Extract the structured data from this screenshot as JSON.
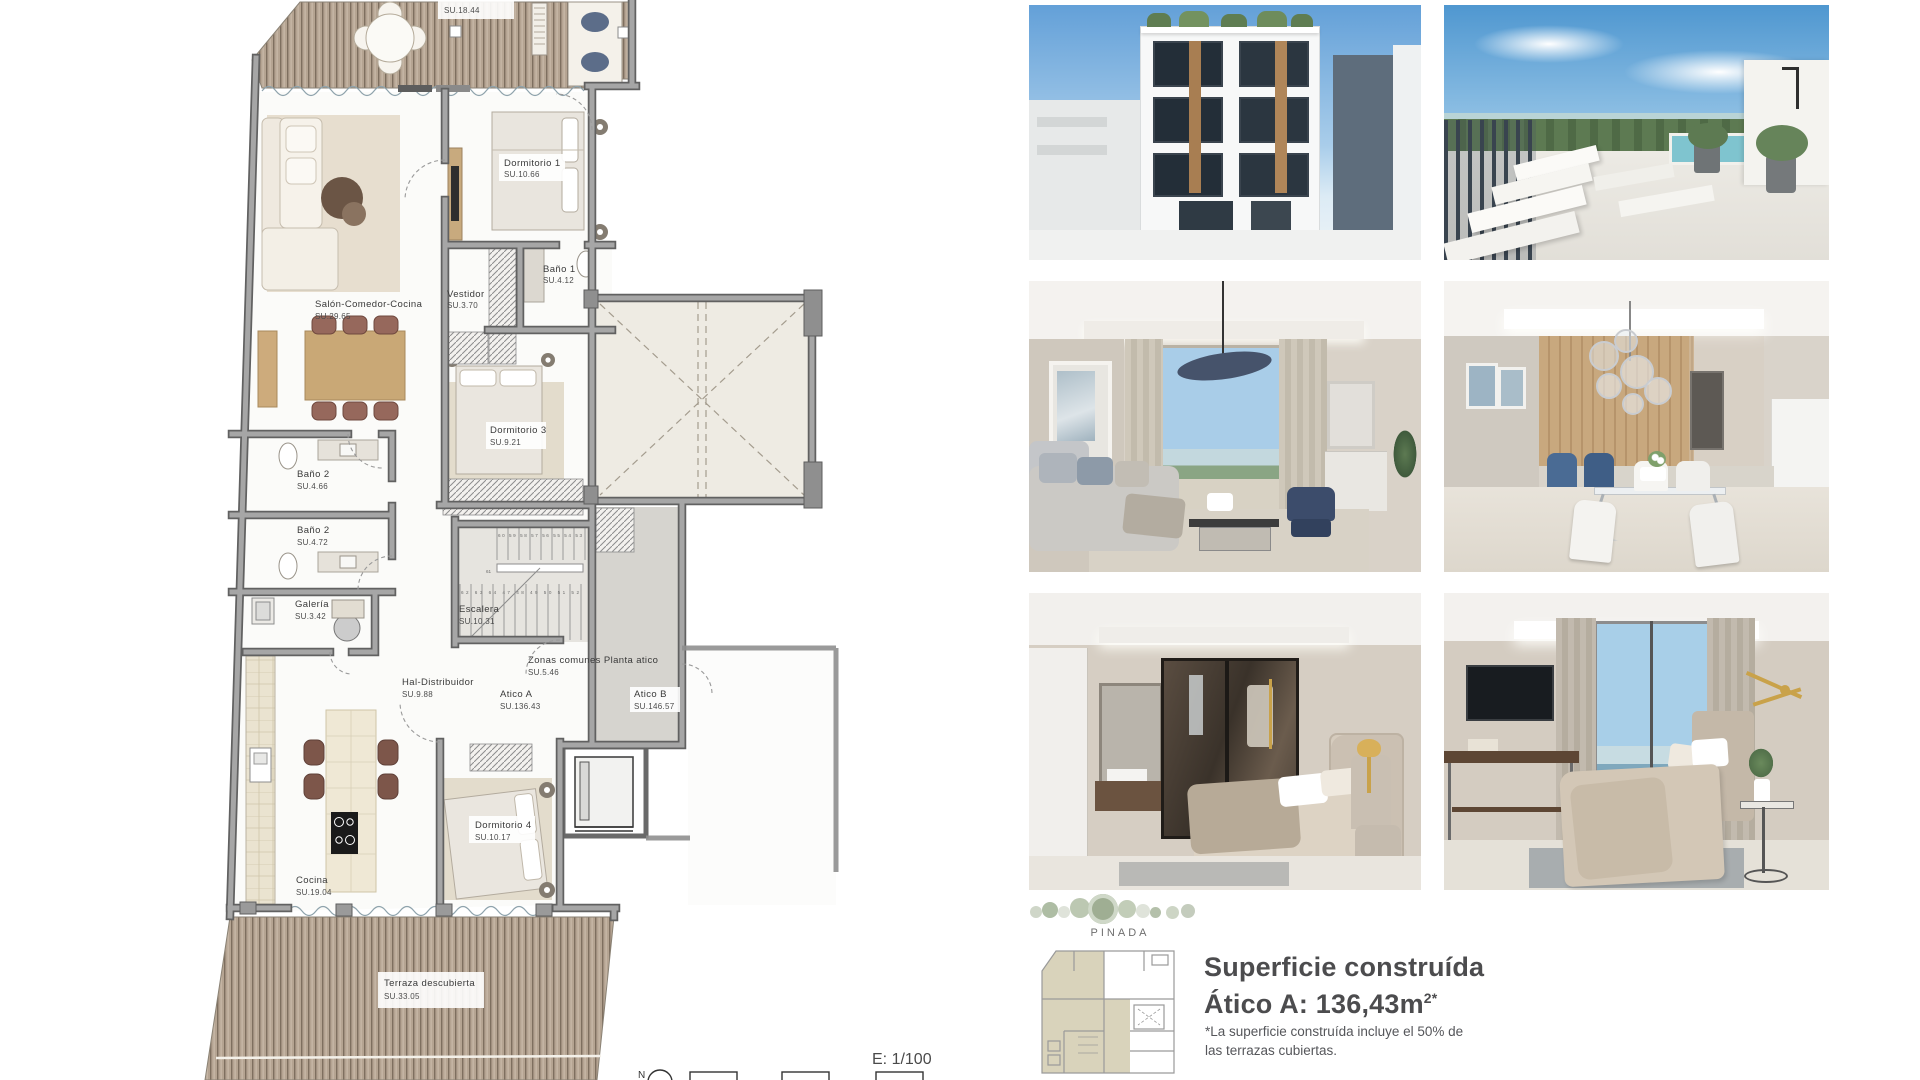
{
  "floorplan": {
    "rooms": [
      {
        "name": "",
        "area": "SU.18.44"
      },
      {
        "name": "Dormitorio 1",
        "area": "SU.10.66"
      },
      {
        "name": "Baño 1",
        "area": "SU.4.12"
      },
      {
        "name": "Vestidor",
        "area": "SU.3.70"
      },
      {
        "name": "Salón-Comedor-Cocina",
        "area": "SU.29.65"
      },
      {
        "name": "Dormitorio 3",
        "area": "SU.9.21"
      },
      {
        "name": "Baño 2",
        "area": "SU.4.66"
      },
      {
        "name": "Baño 2",
        "area": "SU.4.72"
      },
      {
        "name": "Galería",
        "area": "SU.3.42"
      },
      {
        "name": "Escalera",
        "area": "SU.10.31"
      },
      {
        "name": "Hal-Distribuidor",
        "area": "SU.9.88"
      },
      {
        "name": "Zonas comunes Planta atico",
        "area": "SU.5.46"
      },
      {
        "name": "Atico A",
        "area": "SU.136.43"
      },
      {
        "name": "Atico B",
        "area": "SU.146.57"
      },
      {
        "name": "Cocina",
        "area": "SU.19.04"
      },
      {
        "name": "Dormitorio 4",
        "area": "SU.10.17"
      },
      {
        "name": "Terraza descubierta",
        "area": "SU.33.05"
      }
    ],
    "stairs": {
      "flight_top": "60 59 58 57 56 55 54 53",
      "landing": "61",
      "flight_bottom": "62 63 64 47 48 49 50 51 52"
    },
    "footer": {
      "scale_label": "E: 1/100",
      "north_label": "N"
    }
  },
  "info": {
    "brand": "PINADA",
    "title_line1": "Superficie construída",
    "title_line2": "Ático A: 136,43m",
    "title_sup": "2*",
    "note_line1": "*La superficie construída incluye el 50% de",
    "note_line2": "las  terrazas cubiertas."
  },
  "photos": [
    {
      "id": "exterior-facade"
    },
    {
      "id": "rooftop-terrace-pool"
    },
    {
      "id": "living-room"
    },
    {
      "id": "dining-kitchen"
    },
    {
      "id": "bedroom-walkin-wardrobe"
    },
    {
      "id": "bedroom-sea-view"
    }
  ],
  "colors": {
    "wall": "#9a9a9a",
    "deck": "#b5a492",
    "skylight": "#eeebe3",
    "commons": "#d6d4cf",
    "accent_text": "#4c4c4e"
  }
}
